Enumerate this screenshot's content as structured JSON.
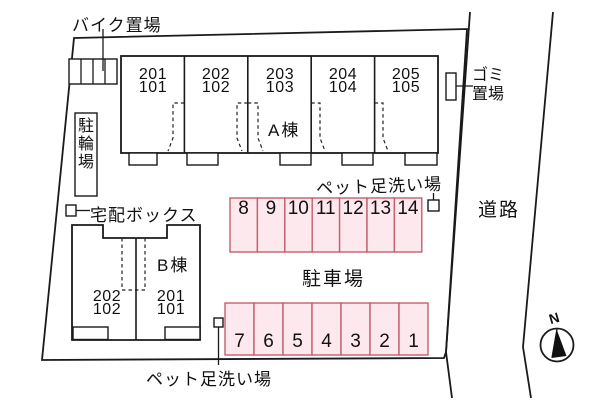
{
  "site": {
    "bike_area": "バイク置場",
    "garbage_line1": "ゴミ",
    "garbage_line2": "置場",
    "bicycle_parking": "駐輪場",
    "delivery_box": "宅配ボックス",
    "pet_wash_top": "ペット足洗い場",
    "pet_wash_bottom": "ペット足洗い場",
    "parking_lot": "駐車場",
    "road": "道路",
    "compass_north": "N"
  },
  "building_a": {
    "name": "A棟",
    "units": [
      {
        "upper": "201",
        "lower": "101"
      },
      {
        "upper": "202",
        "lower": "102"
      },
      {
        "upper": "203",
        "lower": "103"
      },
      {
        "upper": "204",
        "lower": "104"
      },
      {
        "upper": "205",
        "lower": "105"
      }
    ]
  },
  "building_b": {
    "name": "B棟",
    "units": [
      {
        "upper": "202",
        "lower": "102"
      },
      {
        "upper": "201",
        "lower": "101"
      }
    ]
  },
  "parking": {
    "row_top": [
      "8",
      "9",
      "10",
      "11",
      "12",
      "13",
      "14"
    ],
    "row_bottom": [
      "7",
      "6",
      "5",
      "4",
      "3",
      "2",
      "1"
    ]
  },
  "colors": {
    "parcel_fill": "#f0f0f0",
    "building_fill": "#fbf2c6",
    "parking_fill": "#fde9ed",
    "parking_border": "#c2606d",
    "line_color": "#1a1a1a"
  }
}
